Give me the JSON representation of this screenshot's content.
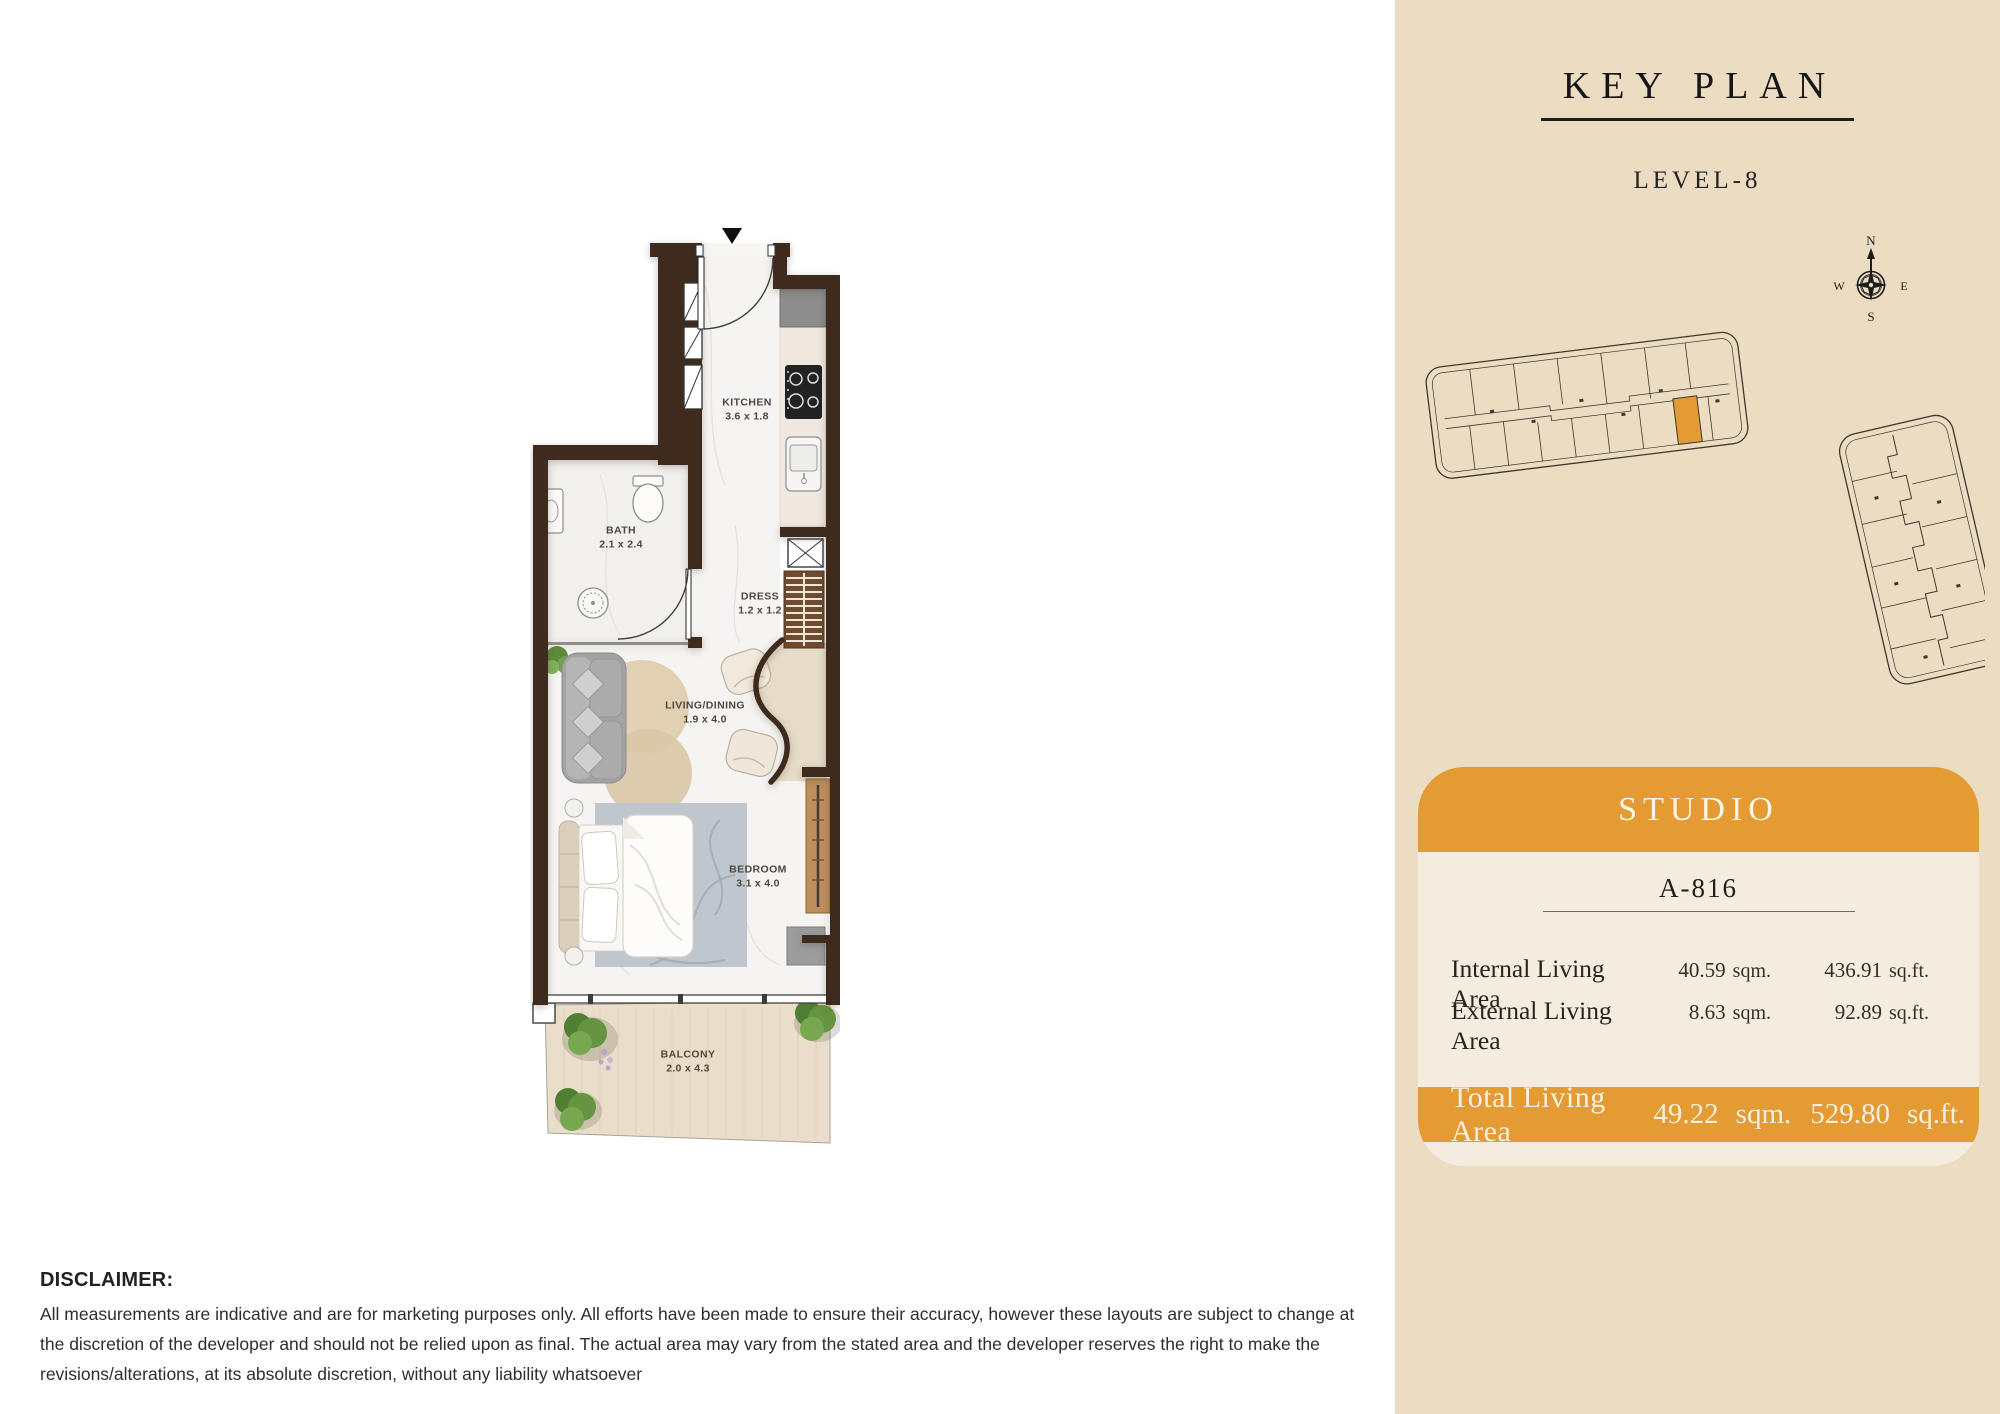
{
  "key_plan": {
    "title": "KEY PLAN",
    "level": "LEVEL-8",
    "compass": {
      "north": "N",
      "east": "E",
      "south": "S",
      "west": "W"
    }
  },
  "unit_card": {
    "type_label": "STUDIO",
    "unit_number": "A-816",
    "rows": [
      {
        "label": "Internal Living Area",
        "sqm_value": "40.59",
        "sqm_unit": "sqm.",
        "sqft_value": "436.91",
        "sqft_unit": "sq.ft."
      },
      {
        "label": "External Living Area",
        "sqm_value": "8.63",
        "sqm_unit": "sqm.",
        "sqft_value": "92.89",
        "sqft_unit": "sq.ft."
      }
    ],
    "total": {
      "label": "Total Living Area",
      "sqm_value": "49.22",
      "sqm_unit": "sqm.",
      "sqft_value": "529.80",
      "sqft_unit": "sq.ft."
    }
  },
  "floor_plan": {
    "rooms": [
      {
        "name": "KITCHEN",
        "dims": "3.6 x 1.8"
      },
      {
        "name": "BATH",
        "dims": "2.1 x 2.4"
      },
      {
        "name": "DRESS",
        "dims": "1.2 x 1.2"
      },
      {
        "name": "LIVING/DINING",
        "dims": "1.9 x 4.0"
      },
      {
        "name": "BEDROOM",
        "dims": "3.1 x 4.0"
      },
      {
        "name": "BALCONY",
        "dims": "2.0 x 4.3"
      }
    ]
  },
  "disclaimer": {
    "heading": "DISCLAIMER:",
    "body": "All measurements are indicative and are for marketing purposes only. All efforts have been made to ensure their accuracy, however these layouts are subject to change at the discretion of the developer and should not be relied upon as final. The actual area may vary from the stated area and the developer reserves the right to make the revisions/alterations, at its absolute discretion, without any liability whatsoever"
  },
  "colors": {
    "accent": "#E59B33",
    "panel_background": "#EBDCC2",
    "card_background": "#F4ECDE",
    "wall": "#3F2B1E"
  }
}
